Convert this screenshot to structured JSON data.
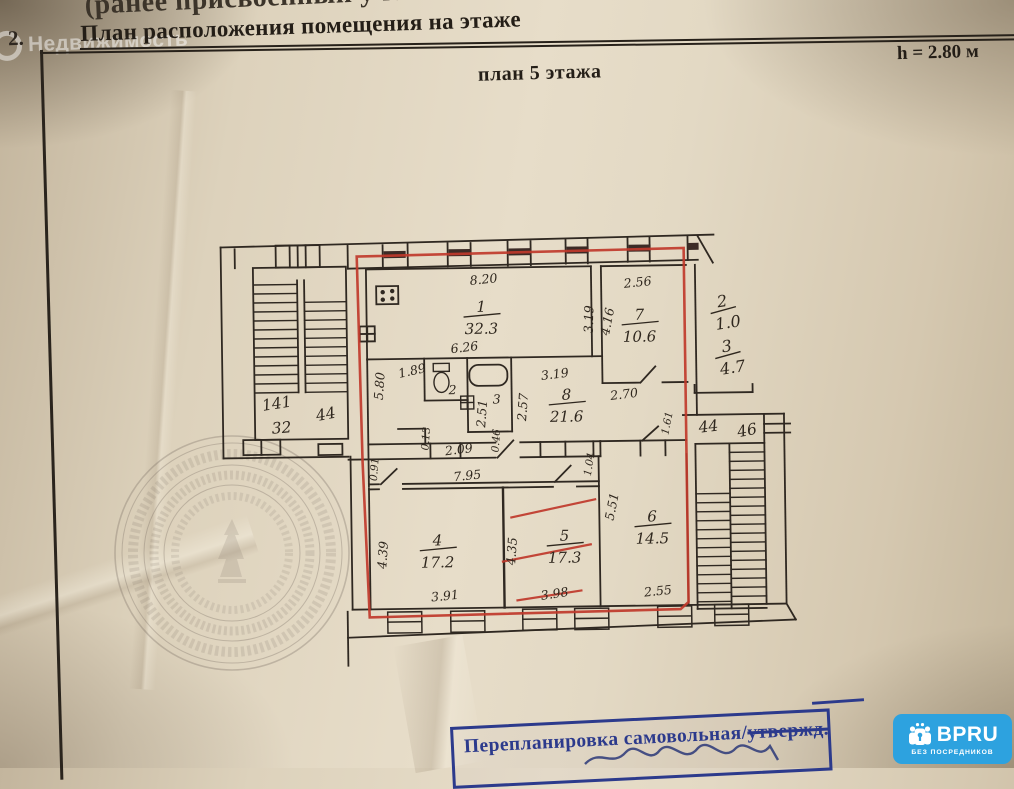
{
  "page": {
    "top_note": "(ранее присвоенный учетный номер)",
    "section_number": "2.",
    "section_title": "План расположения помещения на этаже",
    "height_note": "h = 2.80 м",
    "plan_title": "план 5 этажа"
  },
  "watermark": {
    "brand": "Недвижимость"
  },
  "plan": {
    "rooms": {
      "r1": {
        "num": "1",
        "area": "32.3"
      },
      "r7": {
        "num": "7",
        "area": "10.6"
      },
      "r8": {
        "num": "8",
        "area": "21.6"
      },
      "r4": {
        "num": "4",
        "area": "17.2"
      },
      "r5": {
        "num": "5",
        "area": "17.3"
      },
      "r6": {
        "num": "6",
        "area": "14.5"
      },
      "wc": {
        "num": "2"
      },
      "bath": {
        "num": "3"
      }
    },
    "outside": {
      "o2": {
        "num": "2",
        "area": "1.0"
      },
      "o3": {
        "num": "3",
        "area": "4.7"
      }
    },
    "dims": {
      "top_r1": "8.20",
      "top_r7": "2.56",
      "left_r1": "5.80",
      "niche_r1": "1.89",
      "bottom_r1": "6.26",
      "right_r1": "3.19",
      "left_r7": "4.16",
      "top_r8": "3.19",
      "bottom_r7": "2.70",
      "left_r8": "2.57",
      "bath_h": "2.51",
      "hall_w": "2.09",
      "hall_jog": "0.13",
      "hall_door": "0.46",
      "lower_jog": "0.91",
      "lower_w": "7.95",
      "r6_jog": "1.04",
      "left_r4": "4.39",
      "bottom_r4": "3.91",
      "left_r5": "4.35",
      "bottom_r5": "3.98",
      "left_r6": "5.51",
      "bottom_r6": "2.55",
      "stair_right_jog": "1.61"
    },
    "stairs": {
      "left1": "141",
      "left2": "32",
      "left3": "44",
      "right1": "44",
      "right2": "46"
    }
  },
  "stamp": {
    "main": "Перепланировка самовольная/",
    "struck": "утвержд."
  },
  "logo": {
    "brand": "BPRU",
    "tagline": "БЕЗ ПОСРЕДНИКОВ"
  },
  "colors": {
    "red_outline": "#c0392b",
    "stamp_blue": "#2c3a8c",
    "logo_blue": "#2da2df",
    "ink": "#2f2821"
  }
}
